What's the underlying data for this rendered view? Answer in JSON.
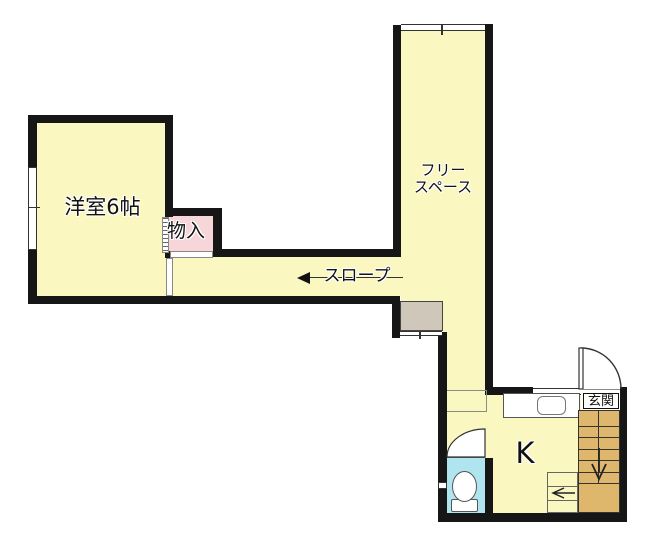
{
  "canvas": {
    "width": 652,
    "height": 540,
    "background": "#FFFFFF"
  },
  "rooms": {
    "western_room": {
      "label": "洋室6帖"
    },
    "closet": {
      "label": "物入"
    },
    "free_space": {
      "label": "フリースペース",
      "line1": "フリー",
      "line2": "スペース"
    },
    "slope": {
      "label": "スロープ",
      "arrow_direction": "left"
    },
    "entrance": {
      "label": "玄関"
    },
    "kitchen": {
      "label": "K"
    },
    "toilet": {
      "label": ""
    }
  },
  "fixtures": {
    "toilet": "western-toilet-bowl-and-tank",
    "kitchen_sink": "counter-with-rounded-sink",
    "stairs": {
      "direction": "down",
      "tread_lines": 6
    },
    "lower_steps": {
      "direction": "left",
      "tread_lines": 2
    },
    "doors": [
      "entrance-swing-door",
      "toilet-swing-door",
      "western-room-sliding-door",
      "closet-folding-door"
    ],
    "windows": [
      "western-room-left-window",
      "free-space-top-window",
      "landing-bottom-window",
      "toilet-left-window",
      "kitchen-top-window"
    ]
  },
  "colors": {
    "floor_yellow": "#FAF7C1",
    "closet_pink": "#F7D6D9",
    "toilet_cyan": "#B0E4EF",
    "stairs_tan": "#DFB76C",
    "landing_gray": "#CEC7BA",
    "wall_black": "#161616"
  }
}
